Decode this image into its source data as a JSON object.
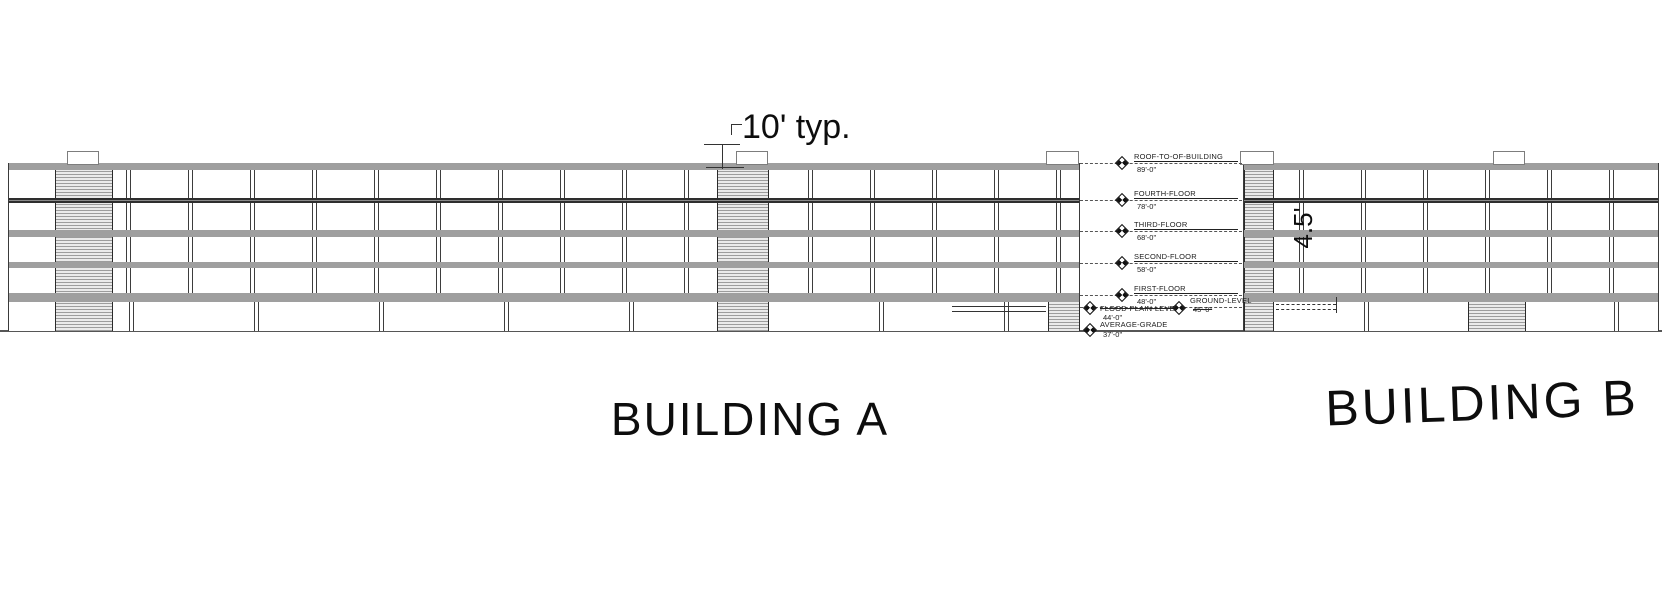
{
  "annotations": {
    "typ_dimension": "10' typ.",
    "vertical_dimension": "4.5'"
  },
  "buildings": {
    "a": "BUILDING A",
    "b": "BUILDING B"
  },
  "levels": [
    {
      "name": "ROOF-TO-OF-BUILDING",
      "elevation": "89'-0\""
    },
    {
      "name": "FOURTH-FLOOR",
      "elevation": "78'-0\""
    },
    {
      "name": "THIRD-FLOOR",
      "elevation": "68'-0\""
    },
    {
      "name": "SECOND-FLOOR",
      "elevation": "58'-0\""
    },
    {
      "name": "FIRST-FLOOR",
      "elevation": "48'-0\""
    },
    {
      "name": "FLOOD-PLAIN-LEVEL",
      "elevation": "44'-0\""
    },
    {
      "name": "GROUND-LEVEL",
      "elevation": "45'-0\""
    },
    {
      "name": "AVERAGE-GRADE",
      "elevation": "37'-0\""
    }
  ],
  "colors": {
    "floor_band": "#9f9f9f",
    "dark_floor_line": "#2e2e2e",
    "hatch_stripe": "#9c9c9c",
    "line": "#3a3a3a",
    "text": "#0d0d0d"
  }
}
